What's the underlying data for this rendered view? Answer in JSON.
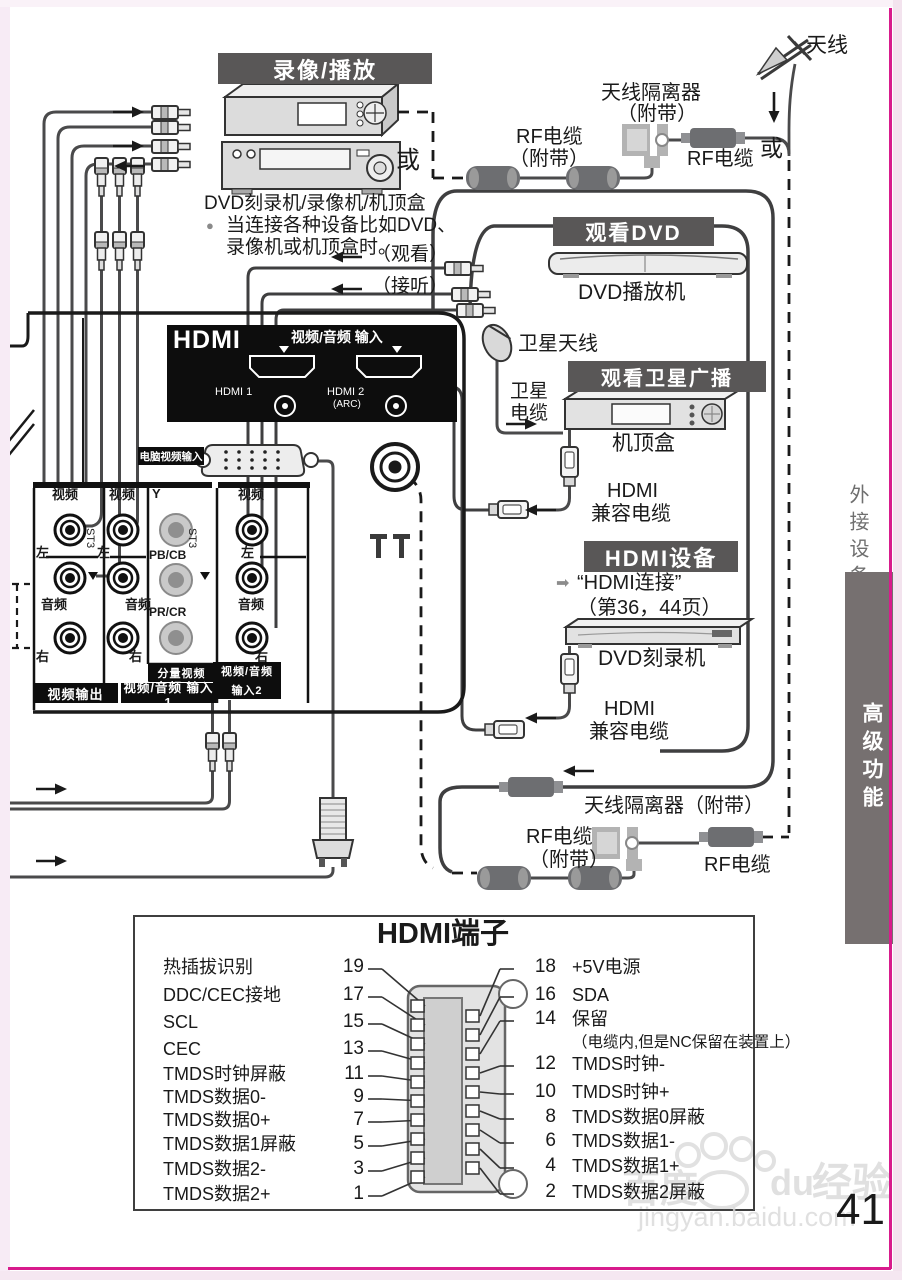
{
  "colors": {
    "frame_pink": "#d81b8c",
    "bar_dark": "#595757",
    "sidebar_gray": "#767070"
  },
  "top_left": {
    "header": "录像/播放",
    "or": "或",
    "caption": "DVD刻录机/录像机/机顶盒",
    "bullet": "●",
    "bullet_line1": "当连接各种设备比如DVD、",
    "bullet_line2": "录像机或机顶盒时。",
    "watch": "（观看）",
    "listen": "（接听）"
  },
  "top_right": {
    "antenna": "天线",
    "isolator_line1": "天线隔离器",
    "isolator_line2": "（附带）",
    "rf_included_line1": "RF电缆",
    "rf_included_line2": "（附带）",
    "rf_cable": "RF电缆",
    "or": "或"
  },
  "panel": {
    "hdmi_logo": "HDMI",
    "av_input": "视频/音频 输入",
    "hdmi1": "HDMI 1",
    "hdmi2": "HDMI 2",
    "arc": "(ARC)",
    "pc_input": "电脑视频输入",
    "video": "视频",
    "left": "左",
    "audio": "音频",
    "right": "右",
    "y": "Y",
    "pb": "PB/CB",
    "pr": "PR/CR",
    "st3": "ST3",
    "component": "分量视频",
    "video_out": "视频输出",
    "av_in1": "视频/音频 输入1",
    "av_in2_line1": "视频/音频",
    "av_in2_line2": "输入2"
  },
  "dvd": {
    "header": "观看DVD",
    "device": "DVD播放机"
  },
  "satellite": {
    "dish": "卫星天线",
    "cable_line1": "卫星",
    "cable_line2": "电缆",
    "header": "观看卫星广播",
    "device": "机顶盒",
    "hdmi_line1": "HDMI",
    "hdmi_line2": "兼容电缆"
  },
  "hdmi_device": {
    "header": "HDMI设备",
    "arrow_glyph": "➡",
    "link": "“HDMI连接”",
    "pages": "（第36，44页）",
    "device": "DVD刻录机",
    "hdmi_line1": "HDMI",
    "hdmi_line2": "兼容电缆"
  },
  "bottom_rf": {
    "isolator": "天线隔离器（附带）",
    "rf_included_line1": "RF电缆",
    "rf_included_line2": "（附带）",
    "rf_cable": "RF电缆"
  },
  "sidebar": {
    "section_top": "外接设备",
    "section_bottom": "高级功能"
  },
  "pinout": {
    "title": "HDMI端子",
    "left_pins": [
      {
        "num": "19",
        "label": "热插拔识别"
      },
      {
        "num": "17",
        "label": "DDC/CEC接地"
      },
      {
        "num": "15",
        "label": "SCL"
      },
      {
        "num": "13",
        "label": "CEC"
      },
      {
        "num": "11",
        "label": "TMDS时钟屏蔽"
      },
      {
        "num": "9",
        "label": "TMDS数据0-"
      },
      {
        "num": "7",
        "label": "TMDS数据0+"
      },
      {
        "num": "5",
        "label": "TMDS数据1屏蔽"
      },
      {
        "num": "3",
        "label": "TMDS数据2-"
      },
      {
        "num": "1",
        "label": "TMDS数据2+"
      }
    ],
    "right_pins": [
      {
        "num": "18",
        "label": "+5V电源"
      },
      {
        "num": "16",
        "label": "SDA"
      },
      {
        "num": "14",
        "label": "保留",
        "note": "（电缆内,但是NC保留在装置上）"
      },
      {
        "num": "12",
        "label": "TMDS时钟-"
      },
      {
        "num": "10",
        "label": "TMDS时钟+"
      },
      {
        "num": "8",
        "label": "TMDS数据0屏蔽"
      },
      {
        "num": "6",
        "label": "TMDS数据1-"
      },
      {
        "num": "4",
        "label": "TMDS数据1+"
      },
      {
        "num": "2",
        "label": "TMDS数据2屏蔽"
      }
    ]
  },
  "footer": {
    "page_number": "41"
  },
  "watermark": {
    "baidu": "百度",
    "du": "du",
    "jingyan": "经验",
    "url": "jingyan.baidu.com"
  }
}
